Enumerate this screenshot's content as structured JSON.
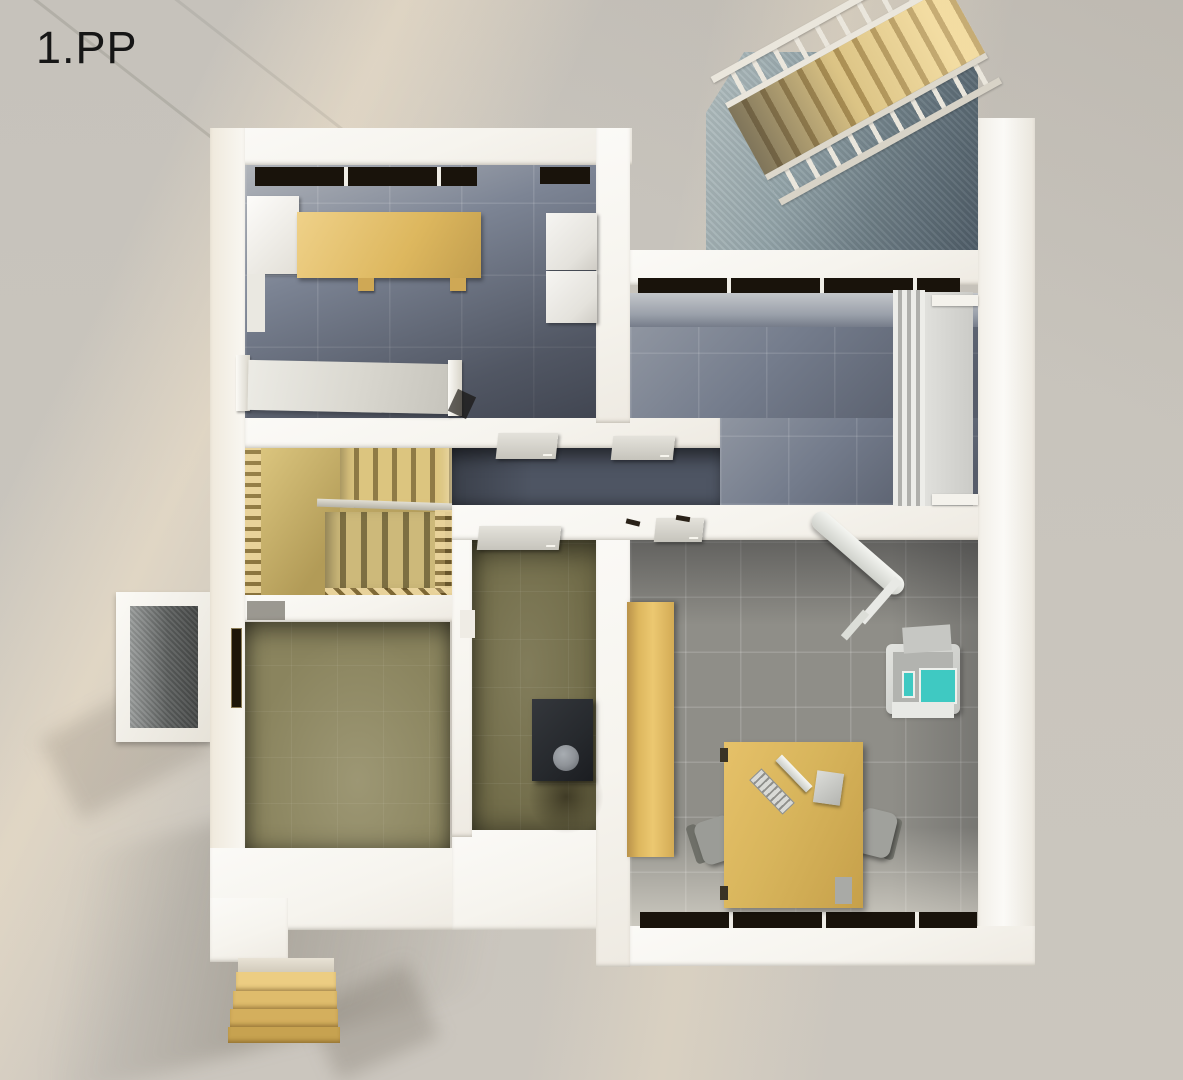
{
  "scene": {
    "floor_label": "1.PP",
    "type": "architectural 3D floor plan render, top-down view of basement level"
  },
  "palette": {
    "bg": "#c9c5bd",
    "wall": "#f6f4ee",
    "windowDark": "#19130b",
    "corridorFloor": "#4e5563",
    "floorBlueGray": "#7c8494",
    "floorOlive": "#8a845e",
    "floorOffice": "#8f8e88",
    "wood": "#ddb75e",
    "woodLight": "#efd189",
    "deskWood": "#d8b55c",
    "railWhite": "#eae6dc",
    "applianceWhite": "#e4e2dc",
    "furnaceDark": "#26292d",
    "furnaceLid": "#8f9398",
    "teal": "#3fc9c2"
  },
  "rooms": [
    {
      "id": "top-left-room",
      "floor": "blue-gray tile"
    },
    {
      "id": "top-right-room",
      "floor": "blue-gray tile"
    },
    {
      "id": "corridor",
      "floor": "dark gray tile"
    },
    {
      "id": "stairwell",
      "floor": "wooden stairs"
    },
    {
      "id": "boiler-room",
      "floor": "olive tile"
    },
    {
      "id": "bottom-left-room",
      "floor": "olive tile"
    },
    {
      "id": "office-room",
      "floor": "gray tile"
    }
  ],
  "objects": [
    "exterior-entrance-staircase",
    "stairwell-pit",
    "interior-wooden-staircase",
    "glass-balustrade",
    "storage-cabinet",
    "workbench",
    "washer-dryer-stack",
    "radiator",
    "corridor-doors",
    "boiler",
    "window-light-well",
    "basement-windows",
    "wardrobe",
    "ironing-board",
    "fitness-machine",
    "desk",
    "keyboard",
    "monitor",
    "pc-tower",
    "office-chair-left",
    "office-chair-right",
    "exterior-steps"
  ]
}
